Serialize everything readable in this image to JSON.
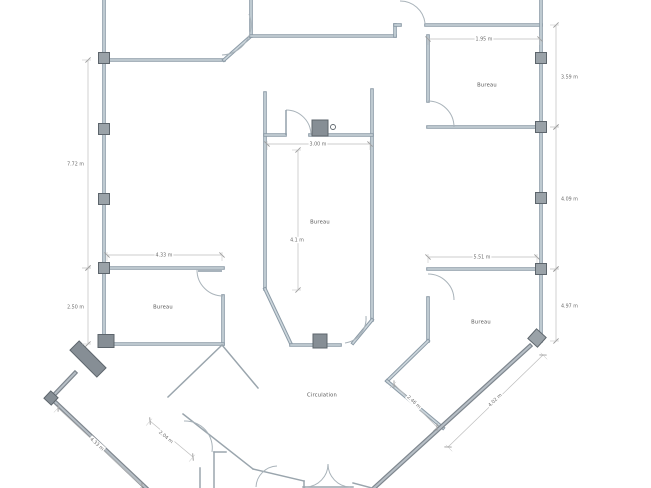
{
  "canvas": {
    "w": 651,
    "h": 488
  },
  "colors": {
    "bg": "#ffffff",
    "wall_edge": "#8b9aa6",
    "wall_core": "#ccd6dc",
    "outer_edge": "#7e868e",
    "outer_core": "#b7bfc6",
    "thin": "#9aa5ad",
    "door": "#a9b3ba",
    "pillar_fill": "#9aa2a8",
    "pillar_dark": "#868e95",
    "pillar_stroke": "#5d656c",
    "dim": "#bdbdbd",
    "tick": "#9b9b9b",
    "dim_text": "#6b6b6b",
    "room_text": "#555555"
  },
  "rooms": [
    {
      "id": "bureau-top-right",
      "label": "Bureau",
      "x": 487,
      "y": 85
    },
    {
      "id": "bureau-center",
      "label": "Bureau",
      "x": 320,
      "y": 222
    },
    {
      "id": "bureau-left",
      "label": "Bureau",
      "x": 163,
      "y": 307
    },
    {
      "id": "bureau-bottom-right",
      "label": "Bureau",
      "x": 481,
      "y": 322
    },
    {
      "id": "circulation",
      "label": "Circulation",
      "x": 322,
      "y": 395
    }
  ],
  "dimensions": [
    {
      "label": "1.95 m",
      "x1": 428,
      "y1": 39,
      "x2": 540,
      "y2": 39,
      "lx": 484,
      "ly": 39,
      "rot": 0,
      "bg": true
    },
    {
      "label": "3.59 m",
      "x1": 556,
      "y1": 25,
      "x2": 556,
      "y2": 127,
      "lx": 561,
      "ly": 77,
      "rot": 0,
      "anchor": "start"
    },
    {
      "label": "4.09 m",
      "x1": 556,
      "y1": 127,
      "x2": 556,
      "y2": 269,
      "lx": 561,
      "ly": 199,
      "rot": 0,
      "anchor": "start"
    },
    {
      "label": "4.97 m",
      "x1": 556,
      "y1": 269,
      "x2": 556,
      "y2": 341,
      "lx": 561,
      "ly": 306,
      "rot": 0,
      "anchor": "start"
    },
    {
      "label": "7.72 m",
      "x1": 88,
      "y1": 60,
      "x2": 88,
      "y2": 268,
      "lx": 84,
      "ly": 164,
      "rot": 0,
      "anchor": "end"
    },
    {
      "label": "2.50 m",
      "x1": 88,
      "y1": 268,
      "x2": 88,
      "y2": 344,
      "lx": 84,
      "ly": 307,
      "rot": 0,
      "anchor": "end"
    },
    {
      "label": "4.33 m",
      "x1": 107,
      "y1": 255,
      "x2": 222,
      "y2": 255,
      "lx": 164,
      "ly": 255,
      "rot": 0,
      "bg": true
    },
    {
      "label": "5.51 m",
      "x1": 428,
      "y1": 257,
      "x2": 537,
      "y2": 257,
      "lx": 482,
      "ly": 257,
      "rot": 0,
      "bg": true
    },
    {
      "label": "3.00 m",
      "x1": 267,
      "y1": 144,
      "x2": 370,
      "y2": 144,
      "lx": 318,
      "ly": 144,
      "rot": 0,
      "bg": true
    },
    {
      "label": "4.1 m",
      "x1": 298,
      "y1": 150,
      "x2": 298,
      "y2": 290,
      "lx": 297,
      "ly": 240,
      "rot": 0,
      "bg": true
    },
    {
      "label": "4.02 m",
      "x1": 448,
      "y1": 447,
      "x2": 543,
      "y2": 355,
      "lx": 495,
      "ly": 400,
      "rot": -44,
      "bg": true
    },
    {
      "label": "2.46 m",
      "x1": 394,
      "y1": 384,
      "x2": 437,
      "y2": 427,
      "lx": 414,
      "ly": 402,
      "rot": 43,
      "bg": true
    },
    {
      "label": "4.33 m",
      "x1": 58,
      "y1": 408,
      "x2": 142,
      "y2": 486,
      "lx": 97,
      "ly": 444,
      "rot": 42,
      "bg": true
    },
    {
      "label": "2.04 m",
      "x1": 150,
      "y1": 421,
      "x2": 193,
      "y2": 457,
      "lx": 166,
      "ly": 437,
      "rot": 40,
      "bg": true
    }
  ],
  "walls": [
    {
      "x1": 104,
      "y1": 0,
      "x2": 104,
      "y2": 345,
      "style": "main"
    },
    {
      "x1": 104,
      "y1": 60,
      "x2": 224,
      "y2": 60,
      "style": "main"
    },
    {
      "x1": 224,
      "y1": 60,
      "x2": 251,
      "y2": 36,
      "style": "main"
    },
    {
      "x1": 251,
      "y1": 36,
      "x2": 251,
      "y2": 0,
      "style": "main"
    },
    {
      "x1": 251,
      "y1": 36,
      "x2": 395,
      "y2": 36,
      "style": "main"
    },
    {
      "x1": 395,
      "y1": 36,
      "x2": 395,
      "y2": 25,
      "style": "main"
    },
    {
      "x1": 395,
      "y1": 25,
      "x2": 400,
      "y2": 25,
      "style": "main"
    },
    {
      "x1": 426,
      "y1": 25,
      "x2": 541,
      "y2": 25,
      "style": "main"
    },
    {
      "x1": 541,
      "y1": 0,
      "x2": 541,
      "y2": 341,
      "style": "main"
    },
    {
      "x1": 428,
      "y1": 36,
      "x2": 428,
      "y2": 101,
      "style": "main"
    },
    {
      "x1": 428,
      "y1": 127,
      "x2": 541,
      "y2": 127,
      "style": "main"
    },
    {
      "x1": 265,
      "y1": 93,
      "x2": 265,
      "y2": 289,
      "style": "main"
    },
    {
      "x1": 372,
      "y1": 90,
      "x2": 372,
      "y2": 320,
      "style": "main"
    },
    {
      "x1": 265,
      "y1": 135,
      "x2": 285,
      "y2": 135,
      "style": "main"
    },
    {
      "x1": 310,
      "y1": 135,
      "x2": 372,
      "y2": 135,
      "style": "main"
    },
    {
      "x1": 265,
      "y1": 289,
      "x2": 291,
      "y2": 344,
      "style": "main"
    },
    {
      "x1": 372,
      "y1": 320,
      "x2": 353,
      "y2": 343,
      "style": "main"
    },
    {
      "x1": 291,
      "y1": 345,
      "x2": 340,
      "y2": 345,
      "style": "main"
    },
    {
      "x1": 104,
      "y1": 268,
      "x2": 223,
      "y2": 268,
      "style": "main"
    },
    {
      "x1": 223,
      "y1": 296,
      "x2": 223,
      "y2": 344,
      "style": "main"
    },
    {
      "x1": 104,
      "y1": 344,
      "x2": 223,
      "y2": 344,
      "style": "main"
    },
    {
      "x1": 428,
      "y1": 269,
      "x2": 537,
      "y2": 269,
      "style": "main"
    },
    {
      "x1": 428,
      "y1": 298,
      "x2": 428,
      "y2": 341,
      "style": "main"
    },
    {
      "x1": 428,
      "y1": 341,
      "x2": 387,
      "y2": 381,
      "style": "main"
    },
    {
      "x1": 387,
      "y1": 381,
      "x2": 443,
      "y2": 428,
      "style": "main"
    },
    {
      "x1": 530,
      "y1": 346,
      "x2": 374,
      "y2": 488,
      "style": "outer"
    },
    {
      "x1": 53,
      "y1": 400,
      "x2": 146,
      "y2": 488,
      "style": "outer"
    },
    {
      "x1": 75,
      "y1": 373,
      "x2": 53,
      "y2": 396,
      "style": "outer"
    },
    {
      "x1": 168,
      "y1": 397,
      "x2": 222,
      "y2": 345,
      "style": "thin"
    },
    {
      "x1": 222,
      "y1": 345,
      "x2": 258,
      "y2": 388,
      "style": "thin"
    },
    {
      "x1": 183,
      "y1": 414,
      "x2": 253,
      "y2": 469,
      "style": "thin"
    },
    {
      "x1": 253,
      "y1": 469,
      "x2": 304,
      "y2": 481,
      "style": "thin"
    },
    {
      "x1": 304,
      "y1": 481,
      "x2": 304,
      "y2": 488,
      "style": "thin"
    },
    {
      "x1": 353,
      "y1": 483,
      "x2": 372,
      "y2": 488,
      "style": "thin"
    },
    {
      "x1": 200,
      "y1": 468,
      "x2": 200,
      "y2": 488,
      "style": "thin"
    },
    {
      "x1": 214,
      "y1": 452,
      "x2": 214,
      "y2": 488,
      "style": "thin"
    },
    {
      "x1": 214,
      "y1": 452,
      "x2": 226,
      "y2": 452,
      "style": "thin"
    },
    {
      "x1": 303,
      "y1": 487,
      "x2": 353,
      "y2": 487,
      "style": "thin"
    }
  ],
  "doors": [
    {
      "name": "door-top-left-chamfer",
      "path": "M 249,14 A 30,30 0 0 1 222,55"
    },
    {
      "name": "door-top-wall",
      "path": "M 400,1 A 25,25 0 0 1 425,23"
    },
    {
      "name": "door-bureau-top-right",
      "path": "M 428,101 A 26,26 0 0 1 454,127"
    },
    {
      "name": "door-bureau-center-top",
      "path": "M 286,110 A 25,25 0 0 1 311,135",
      "leaf": [
        286,
        110,
        286,
        135
      ]
    },
    {
      "name": "door-bureau-left",
      "path": "M 197,270 A 26,26 0 0 0 223,296",
      "leaf": [
        198,
        271,
        222,
        271
      ]
    },
    {
      "name": "door-bureau-center-bottom",
      "path": "M 345,343 A 25,25 0 0 0 366,316"
    },
    {
      "name": "door-bureau-bottom-right",
      "path": "M 428,274 A 26,26 0 0 1 454,300"
    },
    {
      "name": "door-partition-bottom-left",
      "path": "M 184,421 A 27,27 0 0 1 212,452"
    },
    {
      "name": "entrance-double-door-left",
      "path": "M 306,487 A 23,23 0 0 0 328,464"
    },
    {
      "name": "entrance-double-door-right",
      "path": "M 350,487 A 23,23 0 0 1 328,464"
    },
    {
      "name": "door-bottom-small",
      "path": "M 256,487 A 22,22 0 0 1 277,466"
    }
  ],
  "pillars": [
    {
      "x": 104,
      "y": 58
    },
    {
      "x": 104,
      "y": 129
    },
    {
      "x": 104,
      "y": 199
    },
    {
      "x": 104,
      "y": 268
    },
    {
      "x": 541,
      "y": 58
    },
    {
      "x": 541,
      "y": 127
    },
    {
      "x": 541,
      "y": 198
    },
    {
      "x": 541,
      "y": 269
    },
    {
      "x": 537,
      "y": 338,
      "rot": 42,
      "w": 13,
      "h": 13
    },
    {
      "x": 106,
      "y": 341,
      "w": 16,
      "h": 13,
      "dark": true
    },
    {
      "x": 51,
      "y": 398,
      "w": 10,
      "h": 10,
      "rot": 43,
      "dark": true
    },
    {
      "x": 320,
      "y": 128,
      "w": 16,
      "h": 16,
      "dark": true,
      "name": "duct-box"
    },
    {
      "x": 320,
      "y": 341,
      "w": 14,
      "h": 14,
      "dark": true
    },
    {
      "x": 88,
      "y": 359,
      "w": 38,
      "h": 13,
      "rot": 45,
      "dark": true,
      "name": "thick-wall-segment"
    }
  ],
  "circles": [
    {
      "cx": 333,
      "cy": 127,
      "r": 2.5,
      "name": "outlet-symbol"
    }
  ]
}
